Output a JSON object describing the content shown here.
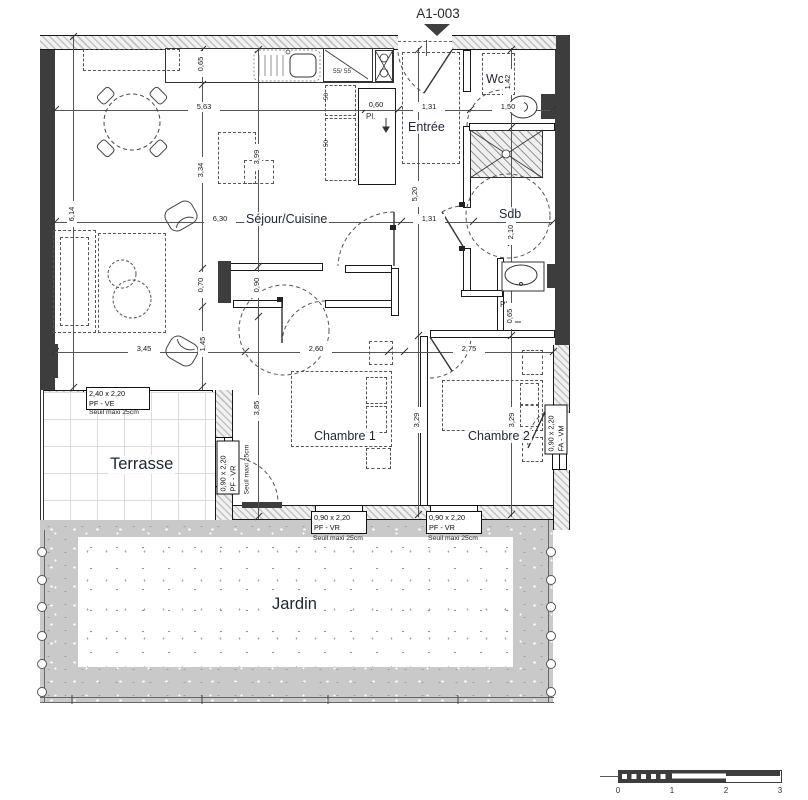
{
  "title": "A1-003",
  "rooms": {
    "sejour": "Séjour/Cuisine",
    "entree": "Entrée",
    "wc": "Wc",
    "sdb": "Sdb",
    "chambre1": "Chambre 1",
    "chambre2": "Chambre 2",
    "terrasse": "Terrasse",
    "jardin": "Jardin"
  },
  "annotations": {
    "placard_kitchen": "Pl.",
    "placard_sdb": "Pl.",
    "fridge": "55/ 55",
    "cabinet_a": "50",
    "cabinet_b": "50"
  },
  "dims": {
    "w_total": "5,63",
    "kitchen_closet": "0,60",
    "entree_w": "1,31",
    "wc_w": "1,50",
    "sejour_w": "6,30",
    "entree_w2": "1,31",
    "sejour_s": "3,45",
    "ch1_w": "2,60",
    "ch2_w": "2,75",
    "left_h": "6,14",
    "k_depth": "0,65",
    "sejour_h": "3,34",
    "sej_s1": "0,70",
    "sej_s2": "1,45",
    "k2_h": "3,99",
    "pass": "0,90",
    "ch1_h": "3,85",
    "corr_h": "5,20",
    "ch1_h2": "3,29",
    "wc_h": "1,42",
    "sdb_h": "2,10",
    "pl_d": "0,65",
    "ch2_h": "3,29"
  },
  "openings": {
    "bay": {
      "size": "2,40 x 2,20",
      "type": "PF - VE",
      "note": "Seuil maxi 25cm"
    },
    "ch1_west": {
      "size": "0,90 x 2,20",
      "type": "PF - VR",
      "note": "Seuil maxi 25cm"
    },
    "ch1_south": {
      "size": "0,90 x 2,20",
      "type": "PF - VR",
      "note": "Seuil maxi 25cm"
    },
    "ch2_south": {
      "size": "0,90 x 2,20",
      "type": "PF - VR",
      "note": "Seuil maxi 25cm"
    },
    "ch2_east": {
      "size": "0,90 x 2,20",
      "type": "FA - VM"
    }
  },
  "scale_bar": {
    "t0": "0",
    "t1": "1",
    "t2": "2",
    "t3": "3"
  },
  "colors": {
    "wall": "#3d3d3d",
    "hatch_line": "#c3c3c3",
    "dim_text": "#1a1a1a",
    "label_text": "#1f2633"
  }
}
